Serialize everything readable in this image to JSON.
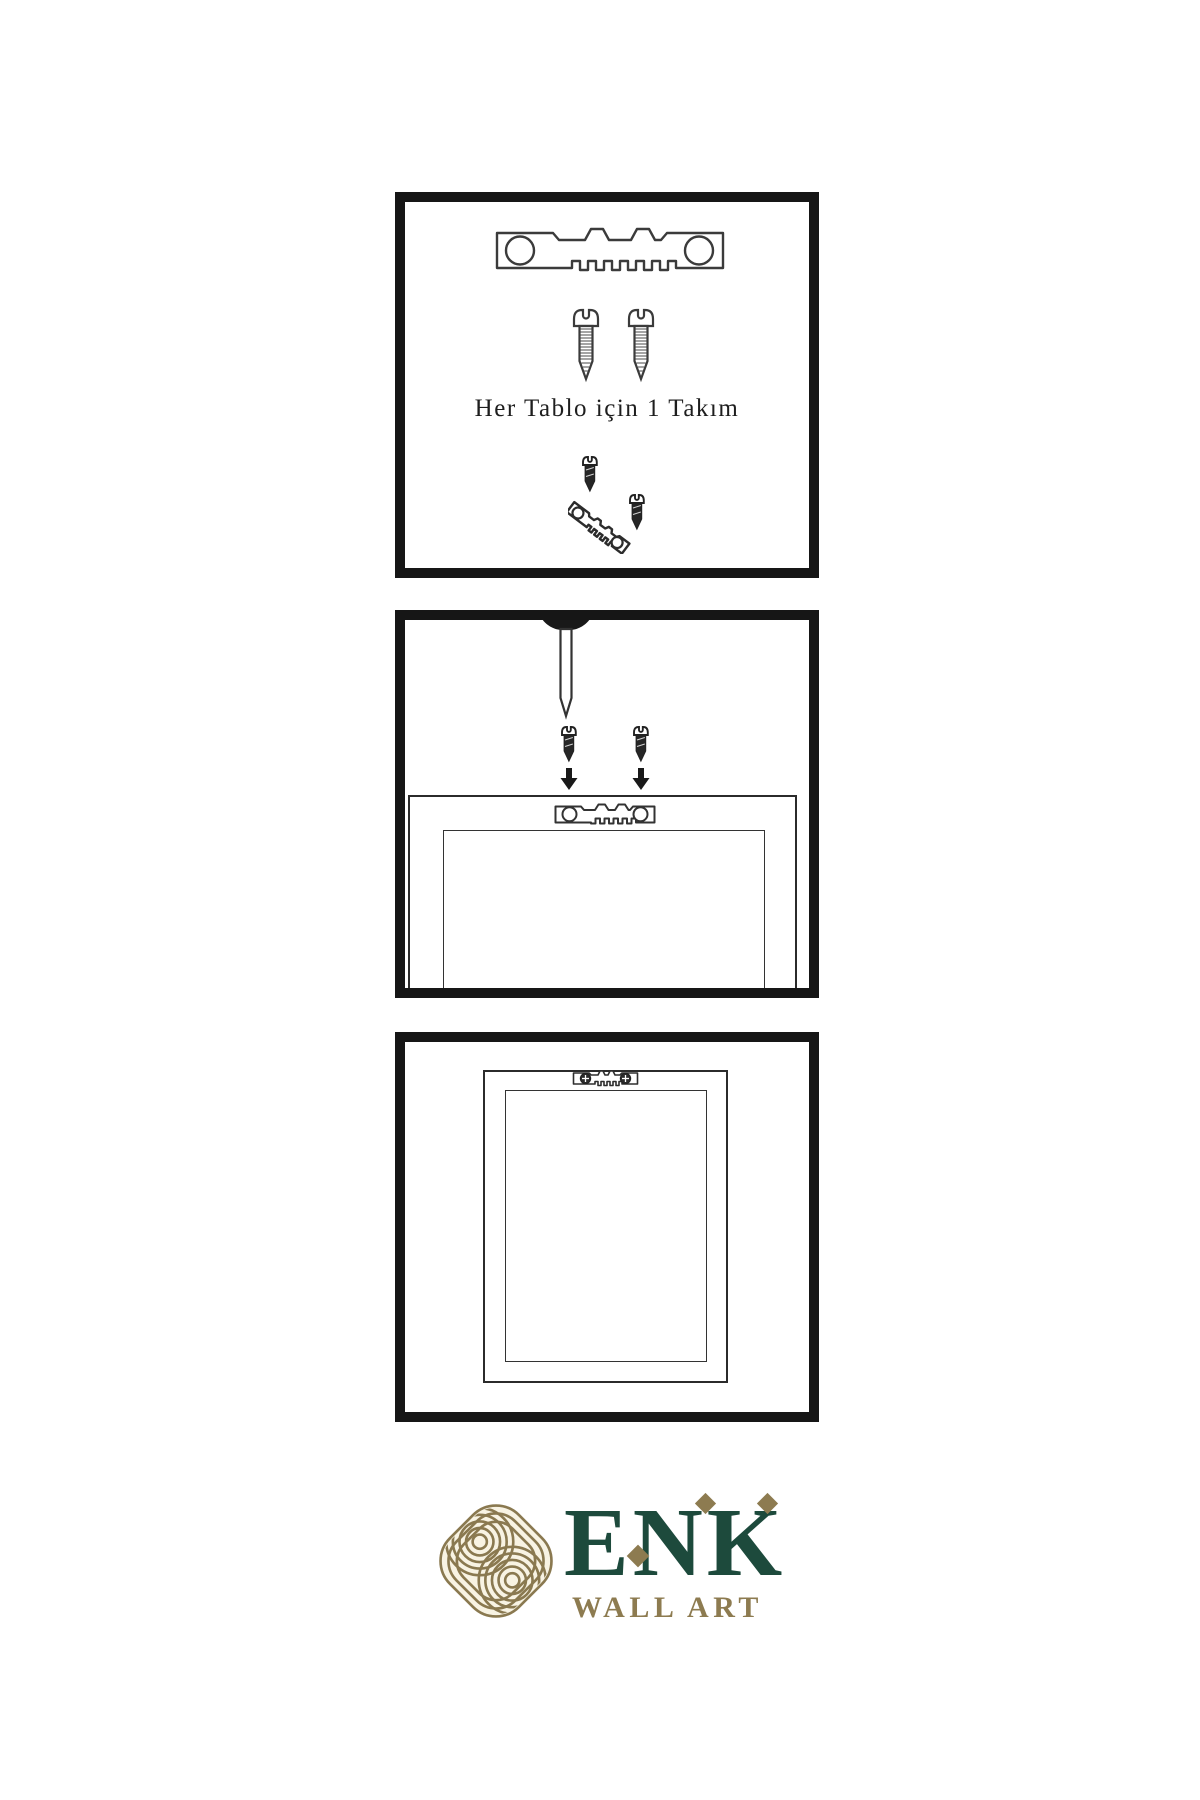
{
  "page": {
    "background": "#ffffff",
    "ink": "#1b1b1b",
    "border_color": "#161616"
  },
  "panels": {
    "kit": {
      "caption": "Her Tablo için 1 Takım"
    },
    "mounting": {
      "caption": ""
    },
    "mounted": {
      "caption": ""
    }
  },
  "logo": {
    "brand": "ENK",
    "tagline": "WALL ART",
    "colors": {
      "green": "#1d4a3c",
      "gold": "#8d7b50",
      "emblem_gold": "#8a7950",
      "emblem_bg": "#f8f3e3"
    }
  },
  "icons": {
    "hanger": "sawtooth-hanger-icon",
    "screw_outline": "screw-icon",
    "screw_dark": "dark-screw-icon",
    "nail": "nail-icon",
    "arrow": "arrow-down-icon",
    "knot": "knot-logo-icon"
  }
}
